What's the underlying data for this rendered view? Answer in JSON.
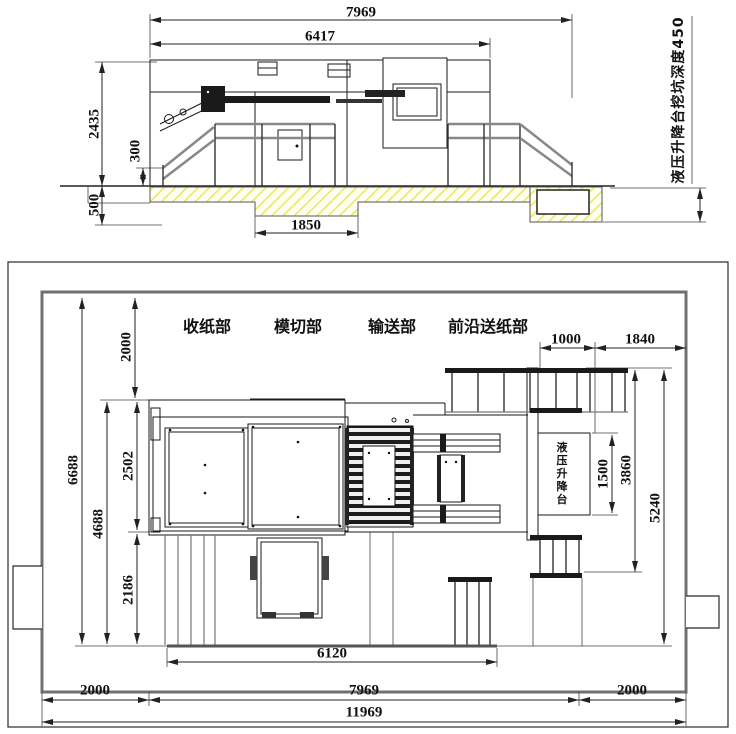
{
  "elevation": {
    "dim_overall_width": "7969",
    "dim_body_width": "6417",
    "dim_height": "2435",
    "dim_base_height": "300",
    "dim_foundation_depth": "500",
    "dim_center_pit_width": "1850",
    "pit_note": "液压升降台挖坑深度450"
  },
  "plan": {
    "label_delivery": "收纸部",
    "label_die_cutting": "模切部",
    "label_transfer": "输送部",
    "label_front_feed": "前沿送纸部",
    "label_lift": "液压升降台",
    "dim_top_margin": "2000",
    "dim_zone_height": "6688",
    "dim_machine_depth": "4688",
    "dim_upper_section": "2502",
    "dim_lower_section": "2186",
    "dim_feed_width": "1000",
    "dim_right_offset": "1840",
    "dim_lift_length": "1500",
    "dim_feed_depth": "3860",
    "dim_right_depth": "5240",
    "dim_foundation_width": "6120",
    "dim_left_margin": "2000",
    "dim_machine_width": "7969",
    "dim_right_margin": "2000",
    "dim_overall_width": "11969"
  }
}
